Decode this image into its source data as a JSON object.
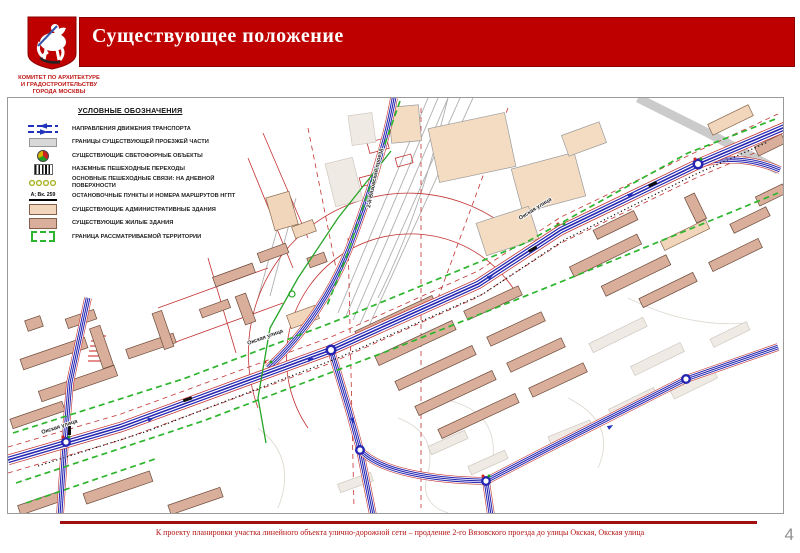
{
  "slide": {
    "title": "Существующее положение",
    "committee": [
      "КОМИТЕТ ПО АРХИТЕКТУРЕ",
      "И ГРАДОСТРОИТЕЛЬСТВУ",
      "ГОРОДА МОСКВЫ"
    ],
    "caption": "К проекту планировки участка линейного объекта улично-дорожной сети – продление 2-го Вязовского проезда до улицы Окская, Окская улица",
    "page_number": "4"
  },
  "legend": {
    "title": "УСЛОВНЫЕ ОБОЗНАЧЕНИЯ",
    "items": [
      {
        "icon": "direction-arrows",
        "label": "НАПРАВЛЕНИЯ ДВИЖЕНИЯ ТРАНСПОРТА"
      },
      {
        "icon": "roadway-bounds",
        "label": "ГРАНИЦЫ СУЩЕСТВУЮЩЕЙ ПРОЕЗЖЕЙ ЧАСТИ"
      },
      {
        "icon": "traffic-light",
        "label": "СУЩЕСТВУЮЩИЕ СВЕТОФОРНЫЕ ОБЪЕКТЫ"
      },
      {
        "icon": "crosswalk",
        "label": "НАЗЕМНЫЕ ПЕШЕХОДНЫЕ ПЕРЕХОДЫ"
      },
      {
        "icon": "pedestrian-links",
        "label": "ОСНОВНЫЕ ПЕШЕХОДНЫЕ СВЯЗИ: НА ДНЕВНОЙ ПОВЕРХНОСТИ"
      },
      {
        "icon": "transit-stop",
        "icon_text": "А; Вк. 259",
        "label": "ОСТАНОВОЧНЫЕ ПУНКТЫ И НОМЕРА МАРШРУТОВ НГПТ"
      },
      {
        "icon": "admin-building",
        "label": "СУЩЕСТВУЮЩИЕ АДМИНИСТРАТИВНЫЕ ЗДАНИЯ"
      },
      {
        "icon": "residential-building",
        "label": "СУЩЕСТВУЮЩИЕ ЖИЛЫЕ ЗДАНИЯ"
      },
      {
        "icon": "territory-boundary",
        "label": "ГРАНИЦА РАССМАТРИВАЕМОЙ ТЕРРИТОРИИ"
      }
    ]
  },
  "map": {
    "street_labels": [
      "Окская улица",
      "Окская улица",
      "Окская улица",
      "2-й Вязовский проезд"
    ]
  },
  "colors": {
    "header_red": "#BE0000",
    "road_blue": "#2626B2",
    "boundary_green": "#2DB52D",
    "roadway_red": "#C03030",
    "residential_fill": "#D9AF9B",
    "admin_fill": "#F2D6BB"
  }
}
